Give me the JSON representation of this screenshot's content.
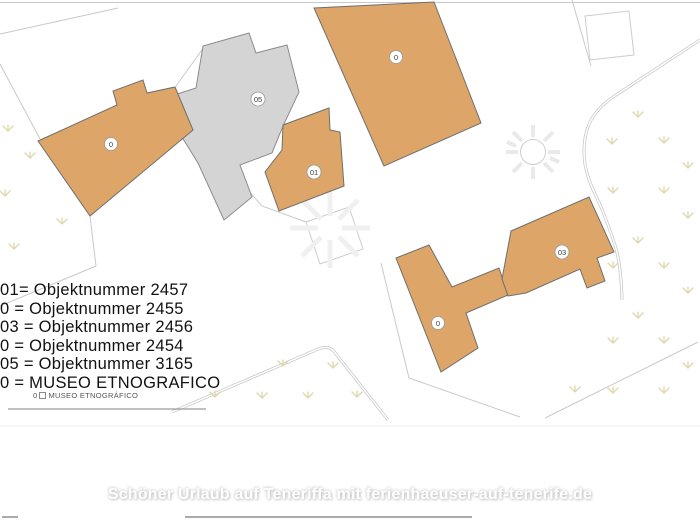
{
  "map": {
    "description": "site plan with building footprints",
    "buildings": [
      {
        "id": "building-left",
        "label": "0",
        "fill": "orange"
      },
      {
        "id": "building-top",
        "label": "0",
        "fill": "orange"
      },
      {
        "id": "building-center-gray",
        "label": "05",
        "fill": "gray"
      },
      {
        "id": "building-middle",
        "label": "01",
        "fill": "orange"
      },
      {
        "id": "building-bottom-left",
        "label": "0",
        "fill": "orange"
      },
      {
        "id": "building-bottom-right",
        "label": "03",
        "fill": "orange"
      }
    ]
  },
  "legend": {
    "entries": [
      "01= Objektnummer 2457",
      "0 = Objektnummer 2455",
      "03 = Objektnummer 2456",
      "0 = Objektnummer 2454",
      "05 = Objektnummer 3165",
      "0 = MUSEO ETNOGRAFICO"
    ],
    "footnote": {
      "prefix": "0",
      "text": "MUSEO ETNOGRÁFICO"
    }
  },
  "watermark": {
    "text": "Schöner Urlaub auf Teneriffa mit ferienhaeuser-auf-tenerife.de"
  },
  "colors": {
    "building_orange": "#dda668",
    "building_gray": "#d4d4d4",
    "outline": "#6e6e6e",
    "parcel_line": "#c9c9c9",
    "plant": "#dfd7ac",
    "watermark_text": "#ffffff",
    "legend_text": "#111111"
  }
}
